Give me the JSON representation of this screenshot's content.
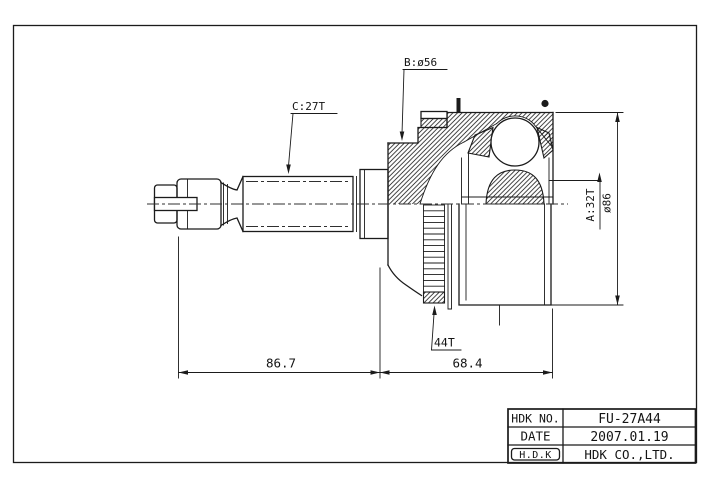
{
  "drawing_labels": {
    "b_diameter": "B:ø56",
    "c_spline": "C:27T",
    "a_spline": "A:32T",
    "a_diameter": "ø86",
    "abs_ring_teeth": "44T"
  },
  "dimensions": {
    "shaft_length": "86.7",
    "joint_length": "68.4"
  },
  "title_block": {
    "rows": [
      {
        "label": "HDK NO.",
        "value": "FU-27A44"
      },
      {
        "label": "DATE",
        "value": "2007.01.19"
      },
      {
        "label": "H.D.K",
        "value": "HDK CO.,LTD."
      }
    ]
  },
  "colors": {
    "line": "#1b1b1b",
    "background": "#ffffff"
  }
}
